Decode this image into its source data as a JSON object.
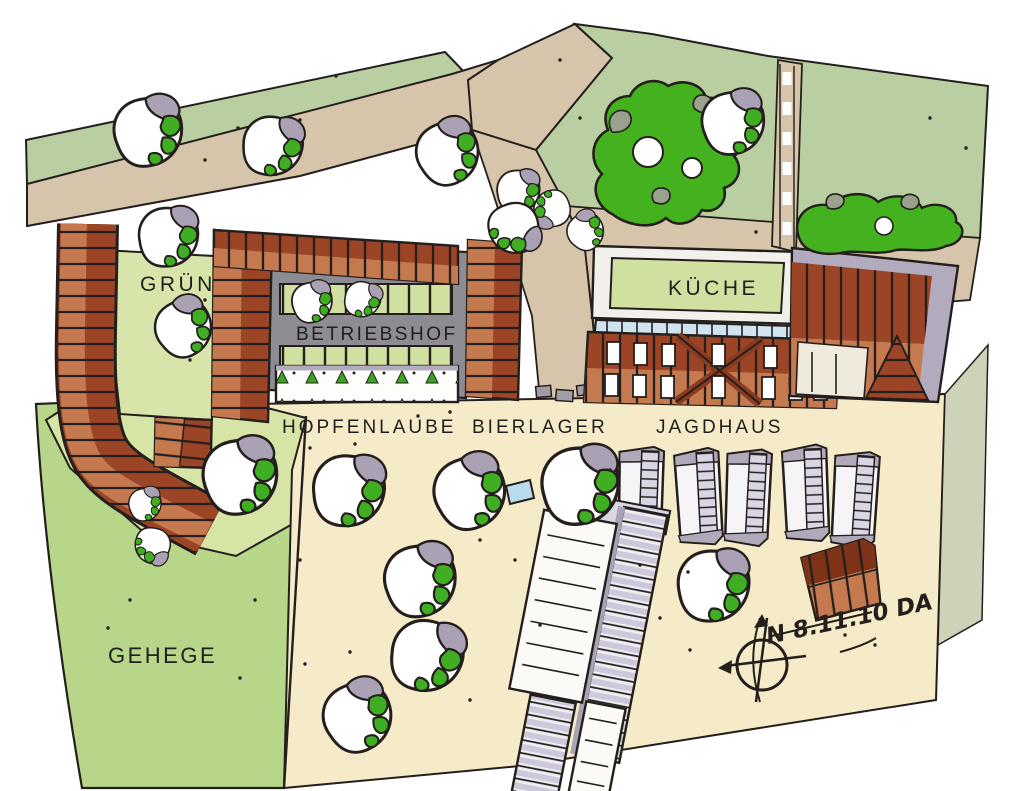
{
  "areas": [
    {
      "id": "gruen",
      "label": "GRÜN",
      "color": "#d8e5aa"
    },
    {
      "id": "betriebshof",
      "label": "BETRIEBSHOF",
      "color": "#8d8c93"
    },
    {
      "id": "kueche",
      "label": "KÜCHE",
      "color": "#cfe0a0"
    },
    {
      "id": "hopfenlaube",
      "label": "HOPFENLAUBE",
      "color": "#ffffff"
    },
    {
      "id": "bierlager",
      "label": "BIERLAGER",
      "color": "#d6c5ab"
    },
    {
      "id": "jagdhaus",
      "label": "JAGDHAUS",
      "color": "#9c4426"
    },
    {
      "id": "gehege",
      "label": "GEHEGE",
      "color": "#b7d68a"
    }
  ],
  "compass": {
    "note": "N 8.11.10 DA"
  },
  "palette": {
    "paper": "#ffffff",
    "field_green": "#b9cfa1",
    "meadow_green": "#b7d68a",
    "yard_green": "#d8e5aa",
    "road_tan": "#d6c5ab",
    "plaza_cream": "#f5ebc9",
    "roof_dark": "#9c4426",
    "roof_light": "#c5794e",
    "slate_gray": "#8d8c93",
    "lavender_gray": "#b2abbe",
    "foliage_green": "#44b11f",
    "glass_blue": "#cfe4f0",
    "ink": "#241f1c"
  }
}
